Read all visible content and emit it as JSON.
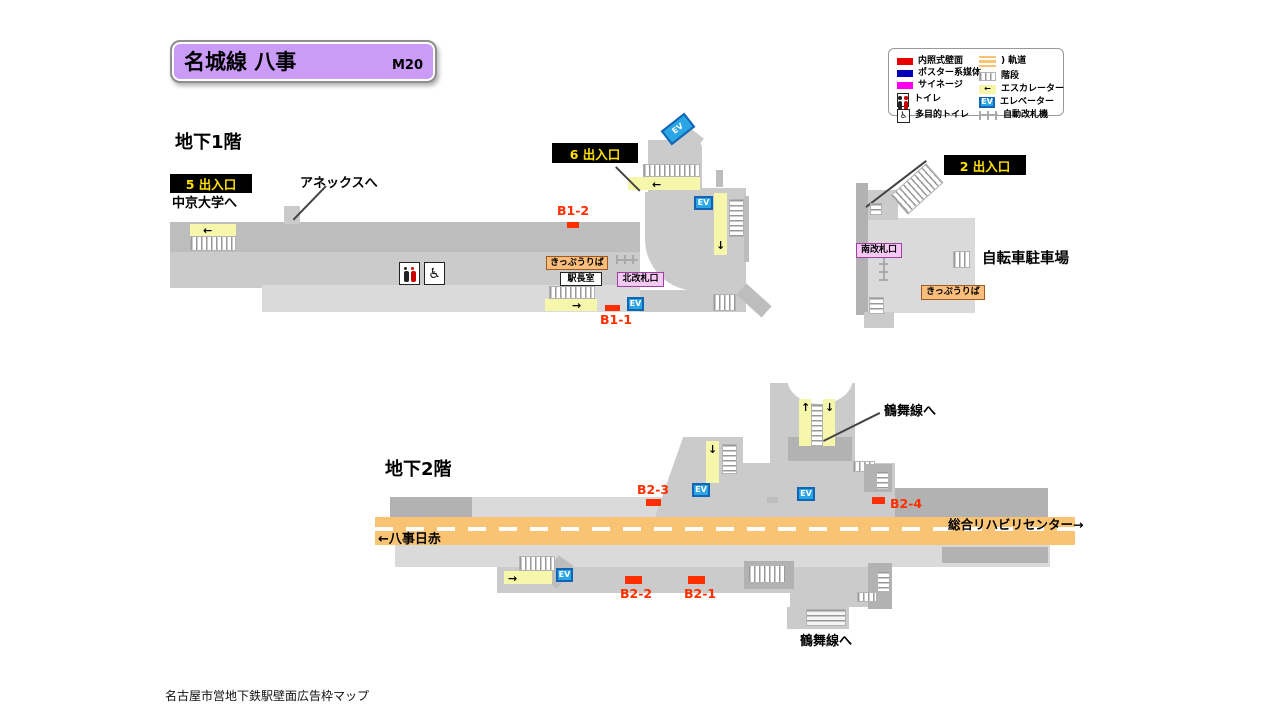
{
  "header": {
    "title": "名城線 八事",
    "station_code": "M20"
  },
  "legend": {
    "left": [
      {
        "name": "illuminated-wall",
        "label": "内照式壁面"
      },
      {
        "name": "poster-media",
        "label": "ポスター系媒体"
      },
      {
        "name": "signage",
        "label": "サイネージ"
      },
      {
        "name": "toilet",
        "label": "トイレ"
      },
      {
        "name": "multipurpose-toilet",
        "label": "多目的トイレ"
      }
    ],
    "right": [
      {
        "name": "track",
        "label": "軌道"
      },
      {
        "name": "stairs",
        "label": "階段"
      },
      {
        "name": "escalator",
        "label": "エスカレーター"
      },
      {
        "name": "elevator",
        "label": "エレベーター"
      },
      {
        "name": "auto-gate",
        "label": "自動改札機"
      }
    ]
  },
  "floors": {
    "b1": "地下1階",
    "b2": "地下2階"
  },
  "exits": {
    "e5": "5 出入口",
    "e6": "6 出入口",
    "e2": "2 出入口"
  },
  "directions": {
    "chukyo": "中京大学へ",
    "annex": "アネックスへ",
    "bicycle": "自転車駐車場",
    "tsurumai_top": "鶴舞線へ",
    "tsurumai_bottom": "鶴舞線へ",
    "rehab_right": "総合リハビリセンター→",
    "nisseki_left": "←八事日赤"
  },
  "facilities": {
    "ticket_north": "きっぷうりば",
    "ticket_south": "きっぷうりば",
    "master_office": "駅長室",
    "north_gate": "北改札口",
    "south_gate": "南改札口",
    "elevator": "EV"
  },
  "ads": {
    "b1_1": "B1-1",
    "b1_2": "B1-2",
    "b2_1": "B2-1",
    "b2_2": "B2-2",
    "b2_3": "B2-3",
    "b2_4": "B2-4"
  },
  "icons": {
    "arrow_left": "←",
    "arrow_right": "→",
    "arrow_up": "↑",
    "arrow_down": "↓",
    "wheelchair": "♿",
    "track_paren": ")"
  },
  "colors": {
    "accent_purple": "#CA9BF7",
    "ad_red": "#FF2E00",
    "exit_badge_bg": "#000000",
    "exit_badge_text": "#FFE100",
    "illuminated_red": "#E80000",
    "poster_blue": "#0000BB",
    "signage_magenta": "#FF00EE",
    "track_orange": "#F8C474",
    "escalator_yellow": "#F7F7AC",
    "elevator_blue": "#2AA5E5",
    "ticket_bg": "#F9BE7C",
    "gate_badge_bg": "#F4C9F4"
  },
  "footer": "名古屋市営地下鉄駅壁面広告枠マップ"
}
